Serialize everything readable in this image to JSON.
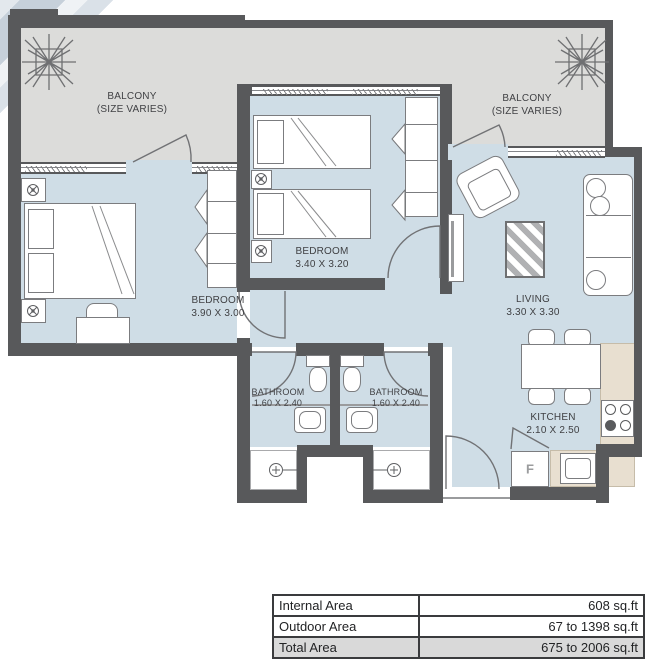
{
  "colors": {
    "wall": "#58595b",
    "interior_floor": "#cfdde6",
    "balcony_floor": "#dcdcda",
    "kitchen_counter": "#e8dfd0",
    "total_row_bg": "#d9d9d9"
  },
  "rooms": {
    "balcony_left": {
      "name": "BALCONY",
      "size_note": "(SIZE VARIES)"
    },
    "balcony_right": {
      "name": "BALCONY",
      "size_note": "(SIZE VARIES)"
    },
    "bedroom_middle": {
      "name": "BEDROOM",
      "dims": "3.40 X 3.20"
    },
    "bedroom_left": {
      "name": "BEDROOM",
      "dims": "3.90 X 3.00"
    },
    "living": {
      "name": "LIVING",
      "dims": "3.30 X 3.30"
    },
    "bathroom_left": {
      "name": "BATHROOM",
      "dims": "1.60 X 2.40"
    },
    "bathroom_right": {
      "name": "BATHROOM",
      "dims": "1.60 X 2.40"
    },
    "kitchen": {
      "name": "KITCHEN",
      "dims": "2.10 X 2.50"
    }
  },
  "labels": {
    "fridge": "F"
  },
  "icons": {
    "plant": "plant-scribble-icon",
    "lamp": "ceiling-lamp-icon",
    "shower": "shower-head-icon"
  },
  "area_table": {
    "rows": [
      {
        "label": "Internal Area",
        "value": "608 sq.ft"
      },
      {
        "label": "Outdoor Area",
        "value": "67 to 1398 sq.ft"
      },
      {
        "label": "Total Area",
        "value": "675 to 2006 sq.ft"
      }
    ]
  }
}
